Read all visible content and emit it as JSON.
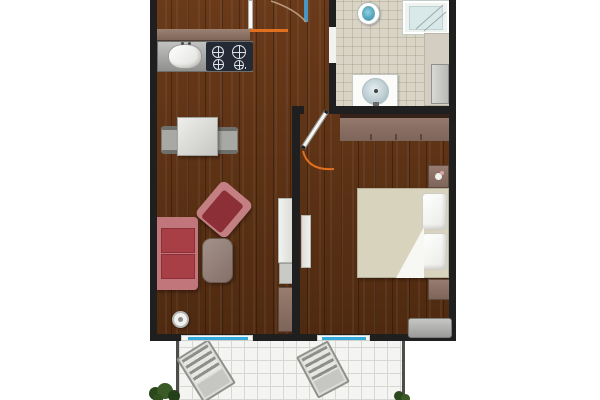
{
  "scene": "apartment-floor-plan-top-view",
  "rooms": {
    "living_kitchen": "Living room with open kitchen",
    "hallway": "Entry hall",
    "bathroom": "Bathroom",
    "bedroom": "Bedroom",
    "balcony": "Balcony"
  },
  "items": {
    "kitchen_counter": "Kitchen counter",
    "kitchen_sink": "Kitchen sink",
    "cooktop": "Cooktop with 4 burners",
    "dining_table": "Dining table",
    "dining_chair": "Dining chair",
    "armchair": "Red armchair",
    "sofa": "Red sofa",
    "coffee_table": "Coffee table",
    "floor_lamp": "Round floor lamp",
    "tv_unit": "TV unit",
    "sideboard": "Sideboard",
    "entry_door": "Entrance door",
    "bathroom_door": "Bathroom door opening",
    "bedroom_door": "Bedroom door with swing arc",
    "toilet": "Toilet",
    "shower": "Shower cabin",
    "bathroom_sink": "Washbasin",
    "washer": "Washing machine",
    "bath_shelf": "Bathroom shelf area",
    "wardrobe": "Wardrobe",
    "nightstand": "Nightstand",
    "bed": "Double bed with pillows and folded blanket",
    "dresser": "Dresser",
    "bedroom_lowboard": "Lowboard",
    "balcony_window_living": "Balcony window living room",
    "balcony_window_bedroom": "Balcony window bedroom",
    "lounger": "Deck chair",
    "plants": "Plants"
  },
  "colors": {
    "wall": "#1f1f1f",
    "wood_floor": "#5d3015",
    "bathroom_tile": "#d9d4c6",
    "balcony_tile": "#f4f4f2",
    "door_swing_accent": "#e0701d",
    "window_glass": "#35aade",
    "upholstery_red": "#ad4a52",
    "cabinet_mauve": "#93786b"
  }
}
